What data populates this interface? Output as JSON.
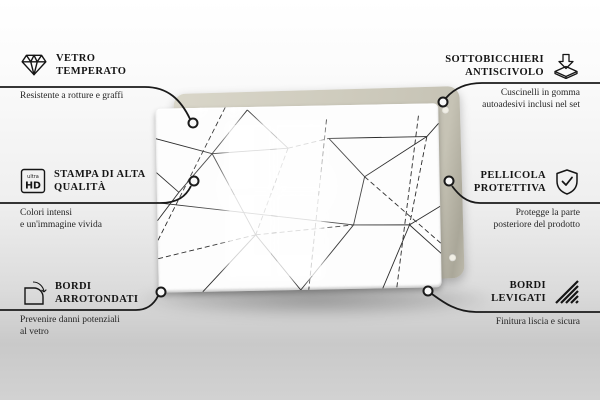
{
  "page": {
    "kind": "product-feature-infographic",
    "language": "it"
  },
  "product": {
    "name": "decorative-glass-board",
    "pattern": "geometric-triangle-line-pattern",
    "backing_board_color": "#cdcabc",
    "glass_color": "#fdfdfd",
    "line_color": "#2b2b2b"
  },
  "colors": {
    "text": "#151515",
    "connector": "#1a1a1a",
    "background_top": "#ffffff",
    "background_bottom": "#c9c9c9"
  },
  "ultra_hd_icon_label": {
    "top": "ultra",
    "bottom": "HD"
  },
  "features": {
    "left": [
      {
        "icon": "diamond-icon",
        "title": [
          "VETRO",
          "TEMPERATO"
        ],
        "desc": [
          "Resistente a rotture e graffi"
        ]
      },
      {
        "icon": "ultra-hd-icon",
        "title": [
          "STAMPA DI ALTA",
          "QUALITÀ"
        ],
        "desc": [
          "Colori intensi",
          "e un'immagine vivida"
        ]
      },
      {
        "icon": "rounded-corner-icon",
        "title": [
          "BORDI",
          "ARROTONDATI"
        ],
        "desc": [
          "Prevenire danni potenziali",
          "al vetro"
        ]
      }
    ],
    "right": [
      {
        "icon": "non-slip-pad-icon",
        "title": [
          "SOTTOBICCHIERI",
          "ANTISCIVOLO"
        ],
        "desc": [
          "Cuscinelli in gomma",
          "autoadesivi inclusi nel set"
        ]
      },
      {
        "icon": "shield-check-icon",
        "title": [
          "PELLICOLA",
          "PROTETTIVA"
        ],
        "desc": [
          "Protegge la parte",
          "posteriore del prodotto"
        ]
      },
      {
        "icon": "polished-edge-icon",
        "title": [
          "BORDI",
          "LEVIGATI"
        ],
        "desc": [
          "Finitura liscia e sicura"
        ]
      }
    ]
  }
}
